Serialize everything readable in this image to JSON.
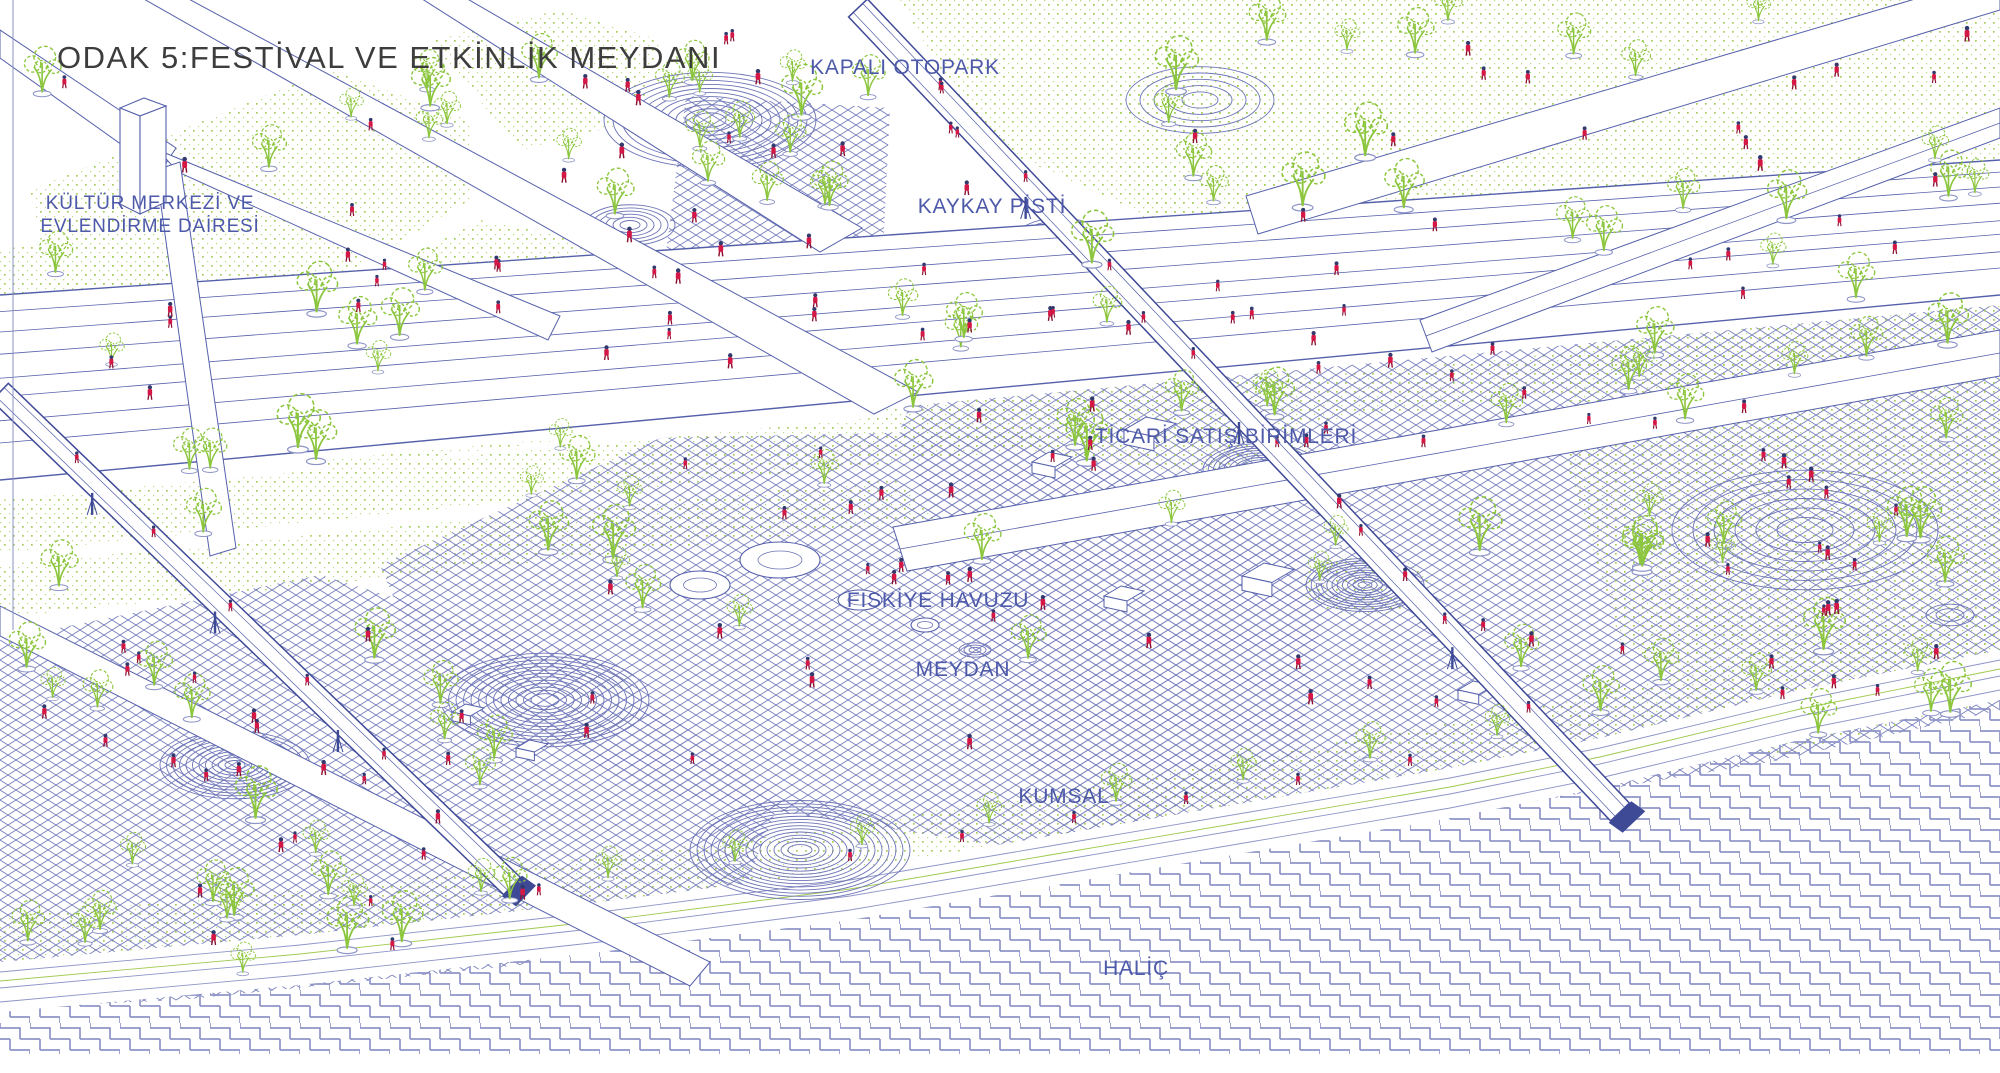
{
  "title": "ODAK 5:FESTİVAL VE ETKİNLİK MEYDANI",
  "labels": {
    "kapali_otopark": "KAPALI OTOPARK",
    "kultur_merkezi_line1": "KÜLTÜR MERKEZİ VE",
    "kultur_merkezi_line2": "EVLENDİRME DAİRESİ",
    "kaykay_pisti": "KAYKAY PİSTİ",
    "ticari_satis_birimleri": "TİCARİ SATIŞ BİRİMLERİ",
    "fiskiye_havuzu": "FISKİYE HAVUZU",
    "meydan": "MEYDAN",
    "kumsal": "KUMSAL",
    "halic": "HALİÇ"
  },
  "colors": {
    "title_text": "#3d3d3d",
    "label_blue": "#4d59a9",
    "line_blue": "#5560ab",
    "contour_blue": "#6d74b6",
    "hatch_blue": "#757dbb",
    "water_blue": "#8e94c7",
    "tree_green": "#8cc63e",
    "dot_green": "#a4cc58",
    "people_red": "#d41744",
    "people_head": "#323a6d",
    "bridge_dark": "#3f4a97"
  }
}
